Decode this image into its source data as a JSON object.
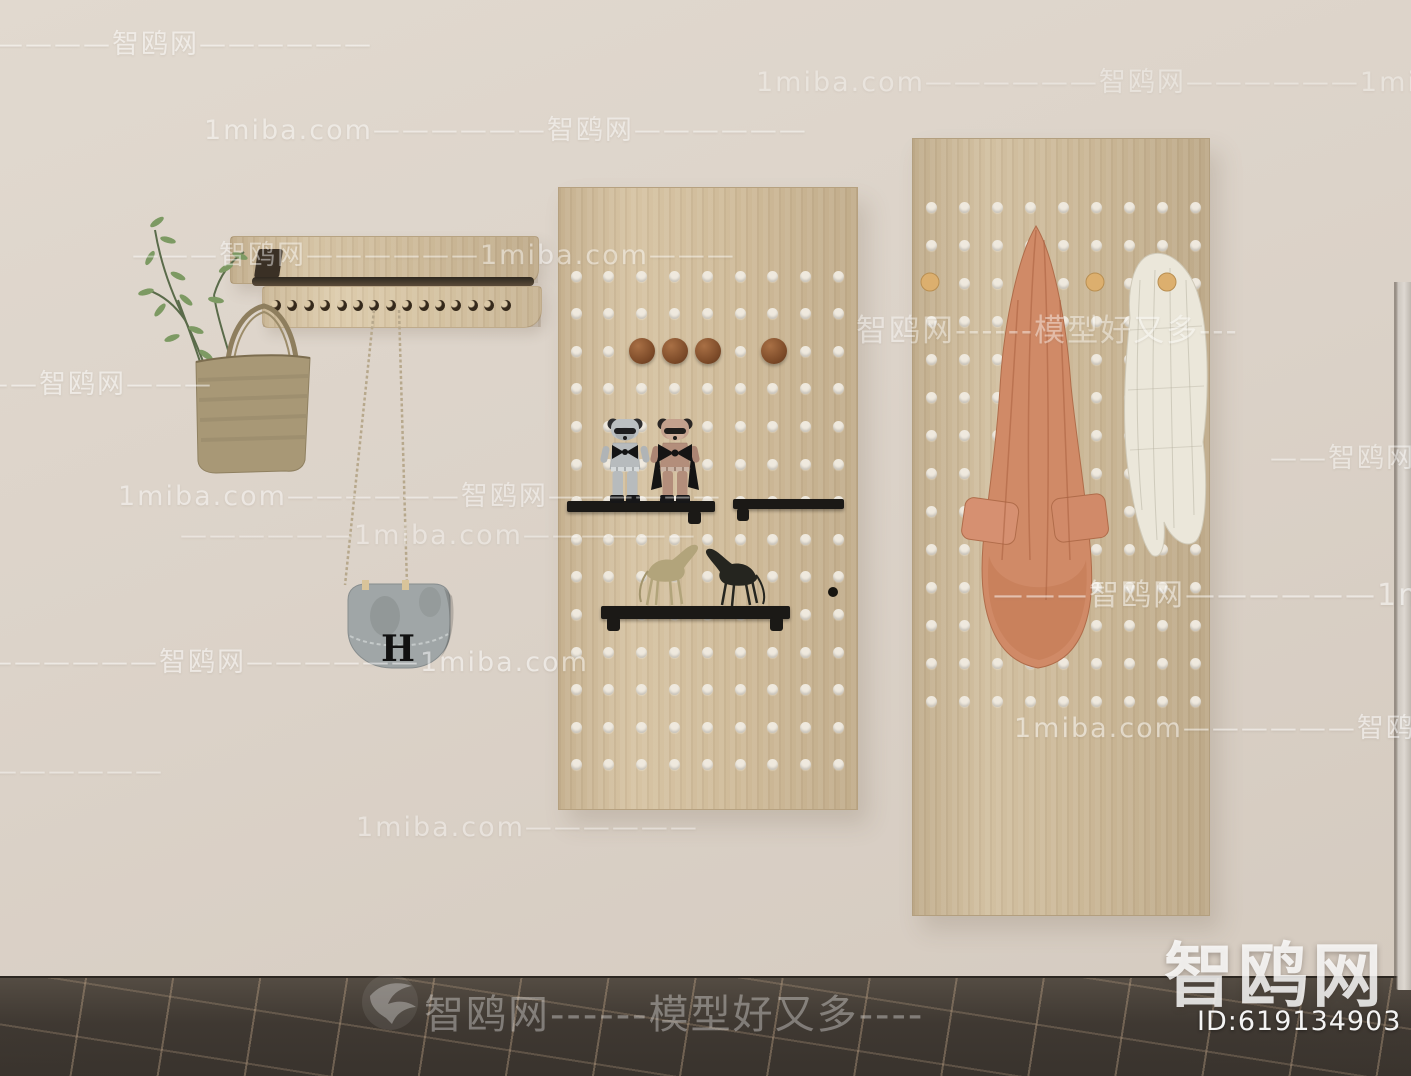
{
  "brand": {
    "site_name_large": "智鸥网",
    "bottom_line_text": "智鸥网------模型好又多----",
    "model_id": "ID:619134903",
    "bird_icon": "seagull"
  },
  "items": {
    "bag_logo": "H"
  },
  "watermarks": {
    "items": [
      {
        "text": "——————智鸥网——————",
        "x": -62,
        "y": 22,
        "size": 27,
        "opacity": 0.5
      },
      {
        "text": "1miba.com——————智鸥网——————",
        "x": 204,
        "y": 108,
        "size": 27,
        "opacity": 0.45
      },
      {
        "text": "1miba.com——————智鸥网——————1miba.com",
        "x": 756,
        "y": 60,
        "size": 27,
        "opacity": 0.35
      },
      {
        "text": "———智鸥网——————1miba.com———",
        "x": 132,
        "y": 233,
        "size": 27,
        "opacity": 0.45
      },
      {
        "text": "———智鸥网———",
        "x": -48,
        "y": 362,
        "size": 27,
        "opacity": 0.5
      },
      {
        "text": "智鸥网------模型好又多---",
        "x": 856,
        "y": 305,
        "size": 31,
        "opacity": 0.42
      },
      {
        "text": "1miba.com——————智鸥网——————",
        "x": 118,
        "y": 474,
        "size": 27,
        "opacity": 0.45
      },
      {
        "text": "——————1miba.com——————",
        "x": 180,
        "y": 520,
        "size": 27,
        "opacity": 0.38
      },
      {
        "text": "——智鸥网———",
        "x": 1270,
        "y": 436,
        "size": 27,
        "opacity": 0.45
      },
      {
        "text": "——————智鸥网——————1miba.com",
        "x": -15,
        "y": 640,
        "size": 27,
        "opacity": 0.5
      },
      {
        "text": "———智鸥网——————1miba.com",
        "x": 993,
        "y": 570,
        "size": 30,
        "opacity": 0.5
      },
      {
        "text": "1miba.com——————智鸥网——————",
        "x": 1014,
        "y": 706,
        "size": 27,
        "opacity": 0.5
      },
      {
        "text": "1miba.com——————",
        "x": 356,
        "y": 812,
        "size": 27,
        "opacity": 0.4
      },
      {
        "text": "——————",
        "x": -10,
        "y": 756,
        "size": 27,
        "opacity": 0.4
      }
    ]
  },
  "theme": {
    "wall": "#dcd3c9",
    "floor": "#474039",
    "floor_seam": "#c4a88a",
    "wood": "#d2bf9e",
    "wood_light": "#dbc9a8",
    "board_mid": "#d4c09e",
    "board_right": "#cfbc9b",
    "hole": "#efe9de",
    "shelf": "#1b1916",
    "knob_brown": "#8a5531",
    "peg_gold": "#dcaf6e",
    "jacket": "#d08a67",
    "sweater": "#ebe7da",
    "tote": "#a89876",
    "bag_gray": "#a0a6a7",
    "plant": "#7d9a63",
    "chain": "#b7a88c",
    "watermark": "#ffffff"
  },
  "scene": {
    "left_rack": {
      "hooks": {
        "count": 15,
        "start_x": 271,
        "step": 16.4,
        "y": 300
      }
    },
    "pegboards": {
      "board-mid": {
        "cols": {
          "start": 17,
          "step": 32.8,
          "count": 9
        },
        "rows": {
          "start": 88,
          "step": 37.6,
          "count": 14
        },
        "knob_r": 13,
        "knobs": [
          {
            "cx": 83,
            "cy": 163
          },
          {
            "cx": 116,
            "cy": 163
          },
          {
            "cx": 149,
            "cy": 163
          },
          {
            "cx": 215,
            "cy": 163
          }
        ],
        "mini_peg": {
          "cx": 274,
          "cy": 404,
          "r": 5
        }
      },
      "board-right": {
        "cols": {
          "start": 18,
          "step": 33,
          "count": 9
        },
        "rows": {
          "start": 68,
          "step": 38,
          "count": 14
        }
      }
    }
  }
}
